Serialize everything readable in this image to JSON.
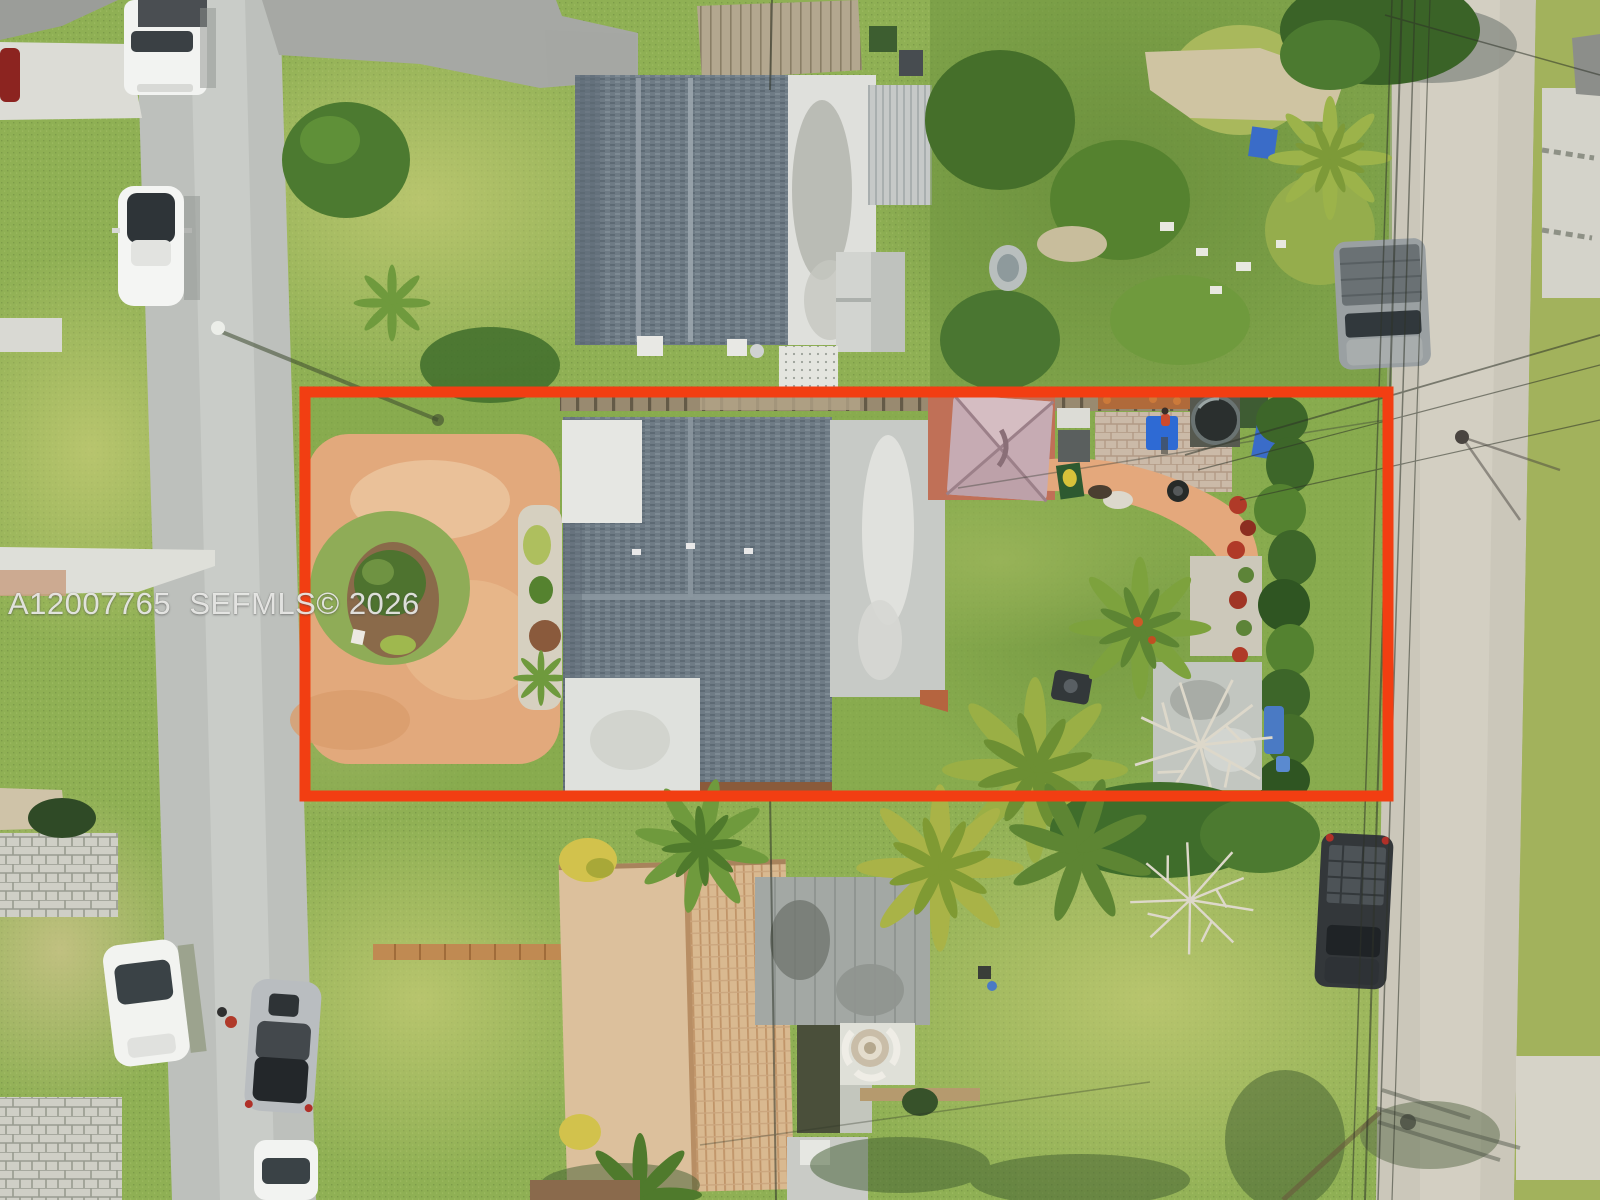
{
  "watermark": {
    "text": "A12007765  SEFMLS© 2026",
    "mls_number": "A12007765",
    "source": "SEFMLS©",
    "year": "2026"
  },
  "scene": {
    "type": "aerial-drone-photo",
    "subject": "residential lot outlined in red between two streets, single-family house with circular paver driveway, backyard patio with umbrella and hot tub",
    "colors": {
      "red_outline": "#f23e12",
      "lawn": "#8fb054",
      "street": "#bdc0bc",
      "right_street": "#cbc7ba",
      "shingle_roof": "#6e7b85",
      "white_roof": "#e6e7e3",
      "gray_roof_section": "#c7cac6",
      "orange_driveway": "#e2a97c",
      "umbrella": "#c6abb3",
      "terracotta_patio": "#c07057",
      "tile_roof": "#dcc09c",
      "flat_roof_addition": "#a3a8a4",
      "blue_bin": "#3a6cc8",
      "hedge": "#3d6629",
      "paver_driveway": "#cfcfc6"
    },
    "objects": [
      "red-boundary-outline",
      "subject-house",
      "circular-driveway",
      "landscape-island",
      "patio-umbrella",
      "outdoor-kitchen",
      "cornhole-board",
      "paver-patio",
      "hot-tub",
      "blue-bins",
      "person",
      "orange-walkway",
      "flower-bed",
      "hedge-row",
      "palm-trees",
      "storage-shed",
      "blue-tarp",
      "dead-tree",
      "bbq-grill",
      "north-neighbor-house",
      "carport",
      "garden-shed",
      "wood-fence",
      "overgrown-lot",
      "kiddie-pool",
      "south-neighbor-house",
      "flat-roof-addition",
      "fire-pit-patio",
      "brick-walkway",
      "left-street",
      "right-street",
      "white-pickup-truck",
      "white-suv",
      "white-sedan",
      "red-car",
      "silver-car",
      "gray-pickup-truck",
      "dark-pickup-truck",
      "street-lamp",
      "power-lines",
      "concrete-driveways",
      "paver-driveways",
      "watermark"
    ]
  }
}
